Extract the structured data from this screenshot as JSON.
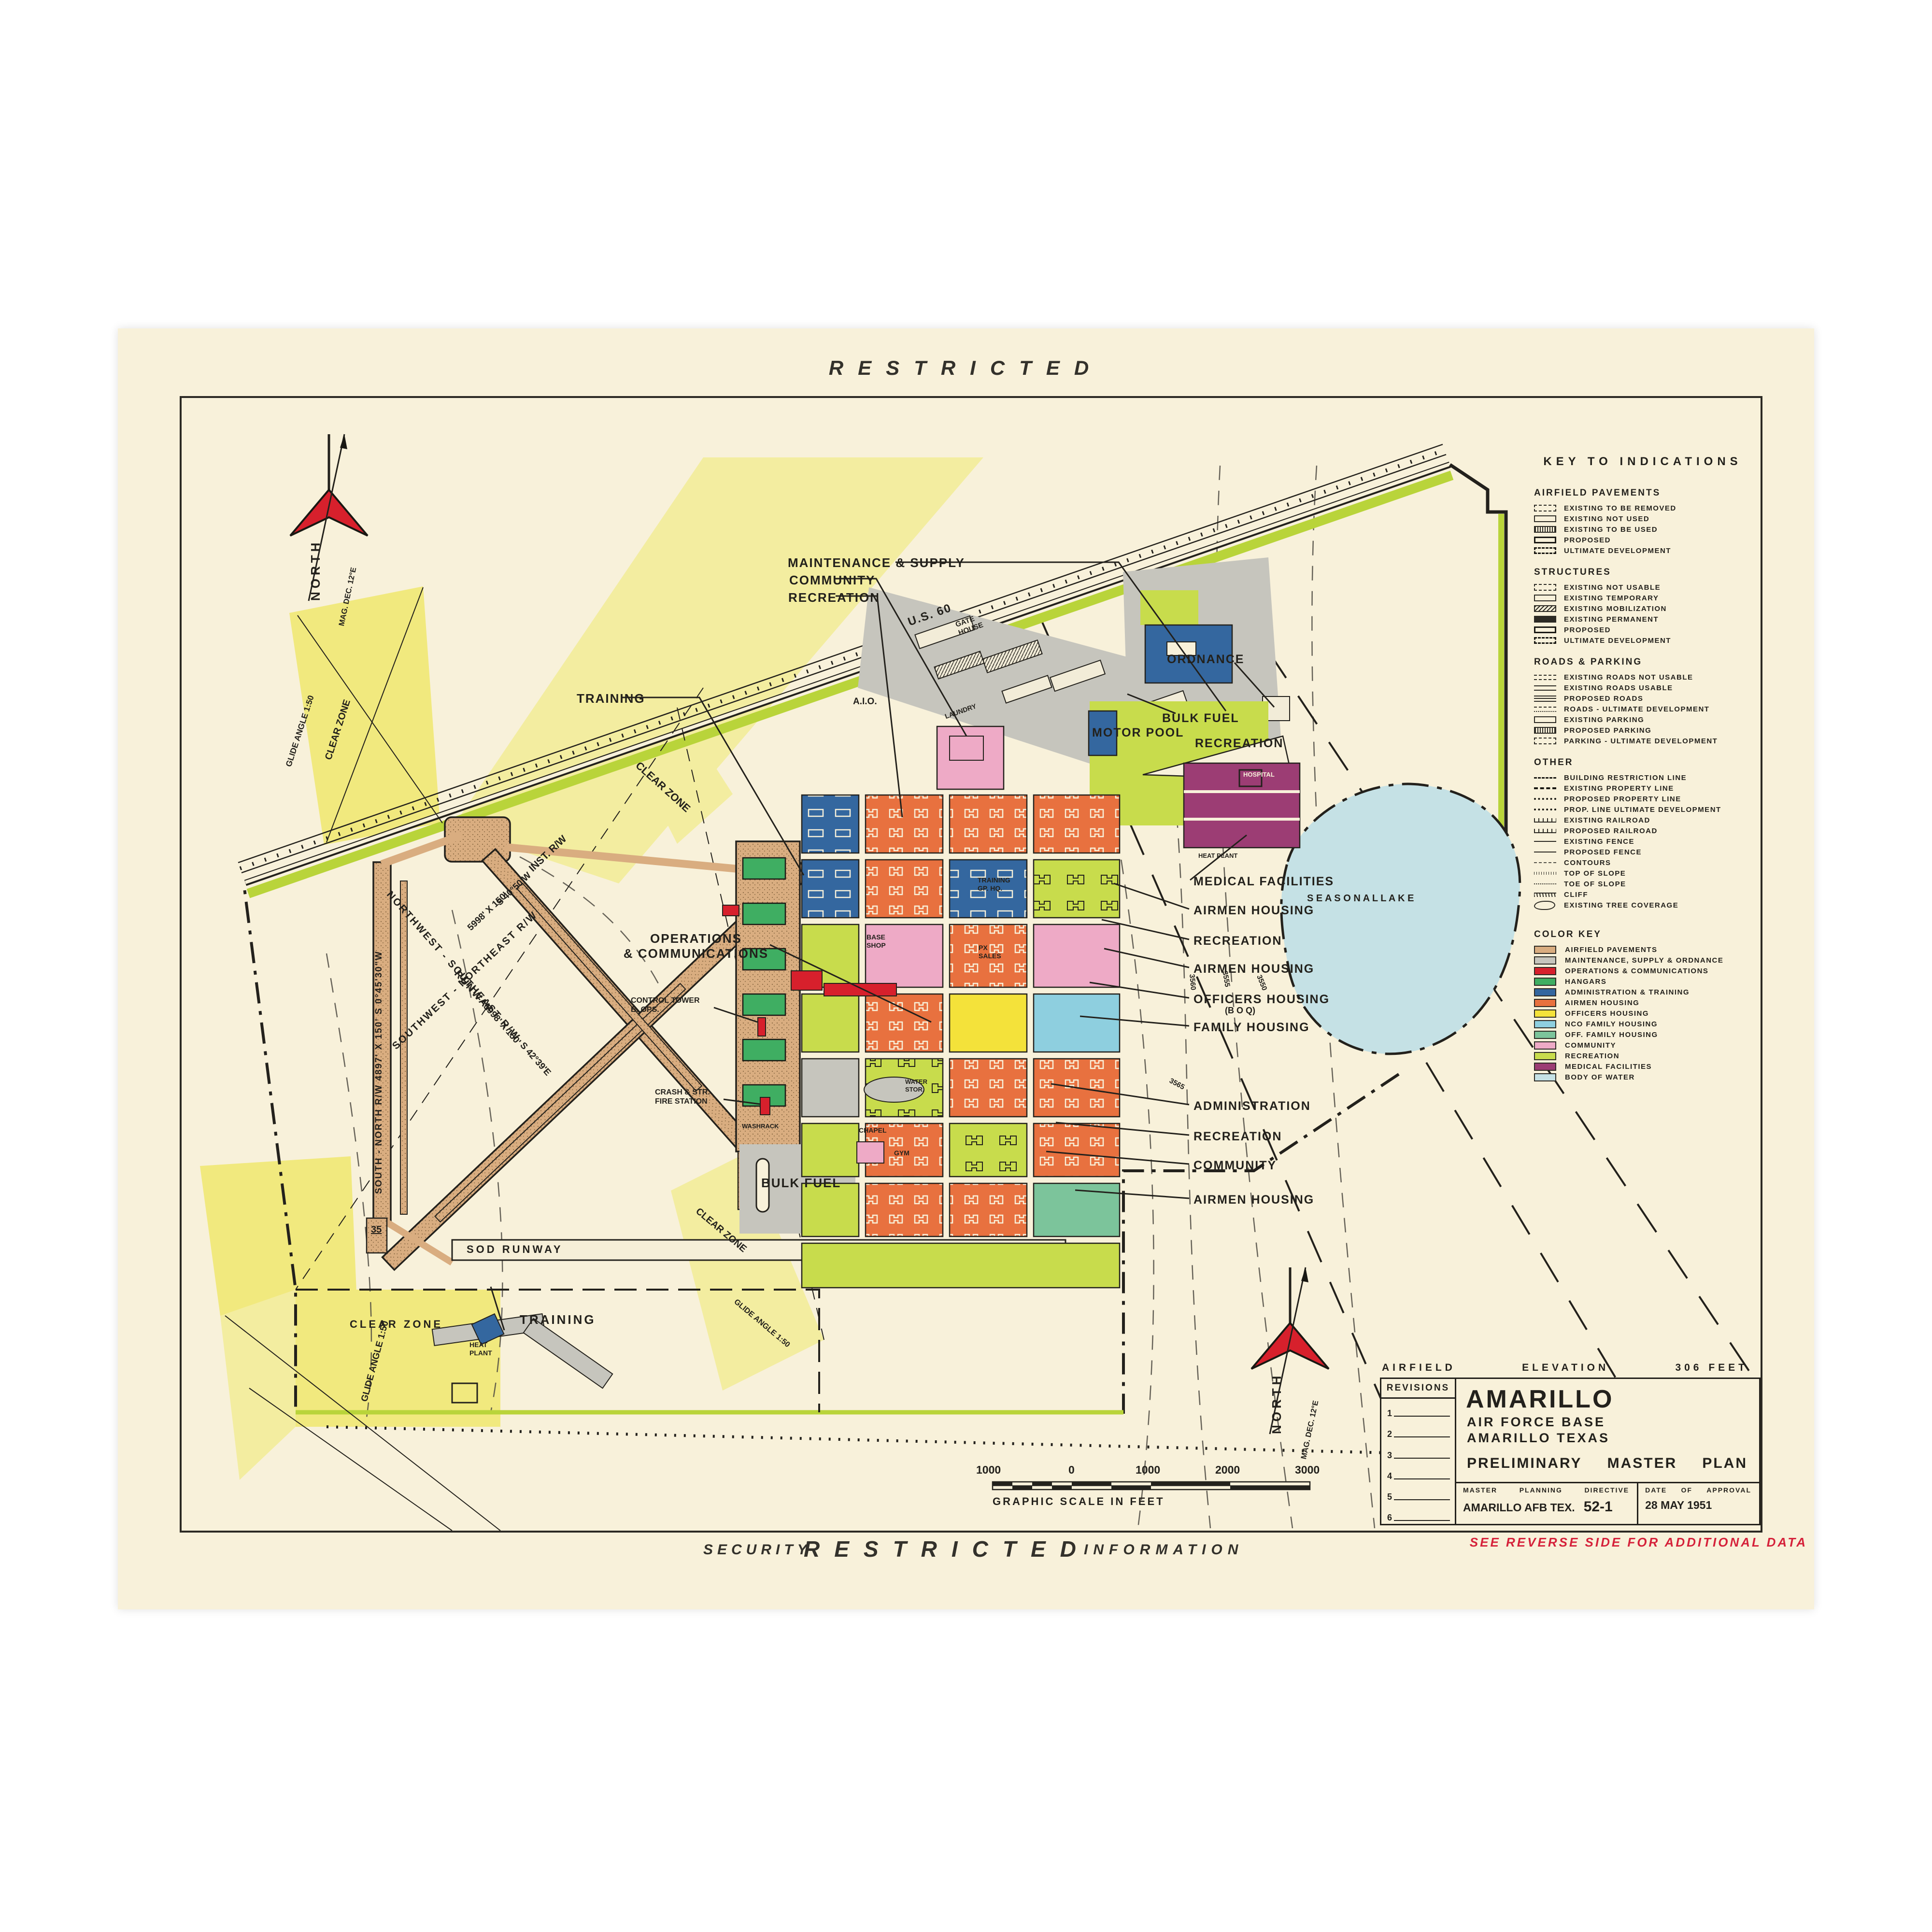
{
  "page": {
    "top_banner": "RESTRICTED",
    "security_word": "SECURITY",
    "restricted_word": "RESTRICTED",
    "information_word": "INFORMATION",
    "see_reverse": "SEE   REVERSE   SIDE   FOR   ADDITIONAL   DATA"
  },
  "colors": {
    "paper": "#f8f1da",
    "airfield_pavements": "#d9ad80",
    "maintenance_supply_ordnance": "#c6c5bd",
    "operations_communications": "#d7202c",
    "hangars": "#3fae62",
    "administration_training": "#34679f",
    "airmen_housing": "#e8713f",
    "officers_housing": "#f4e23a",
    "nco_family_housing": "#8ecfdf",
    "off_family_housing": "#7cc49b",
    "community": "#eeaac6",
    "recreation": "#c8dc4c",
    "medical_facilities": "#9c3d74",
    "body_of_water": "#c5e1e5",
    "clear_zone_yellow": "#f3eda0",
    "boundary_green": "#b9d43a",
    "north_arrow_red": "#d7202c",
    "security_red": "#d5213a"
  },
  "legend": {
    "title": "KEY  TO  INDICATIONS",
    "airfield_pavements": {
      "title": "AIRFIELD  PAVEMENTS",
      "items": [
        "EXISTING  TO  BE  REMOVED",
        "EXISTING  NOT  USED",
        "EXISTING  TO  BE  USED",
        "PROPOSED",
        "ULTIMATE  DEVELOPMENT"
      ]
    },
    "structures": {
      "title": "STRUCTURES",
      "items": [
        "EXISTING  NOT  USABLE",
        "EXISTING  TEMPORARY",
        "EXISTING  MOBILIZATION",
        "EXISTING  PERMANENT",
        "PROPOSED",
        "ULTIMATE  DEVELOPMENT"
      ]
    },
    "roads_parking": {
      "title": "ROADS  &  PARKING",
      "items": [
        "EXISTING  ROADS  NOT  USABLE",
        "EXISTING  ROADS  USABLE",
        "PROPOSED  ROADS",
        "ROADS - ULTIMATE  DEVELOPMENT",
        "EXISTING  PARKING",
        "PROPOSED  PARKING",
        "PARKING - ULTIMATE  DEVELOPMENT"
      ]
    },
    "other": {
      "title": "OTHER",
      "items": [
        "BUILDING  RESTRICTION  LINE",
        "EXISTING  PROPERTY  LINE",
        "PROPOSED  PROPERTY  LINE",
        "PROP. LINE  ULTIMATE  DEVELOPMENT",
        "EXISTING  RAILROAD",
        "PROPOSED  RAILROAD",
        "EXISTING  FENCE",
        "PROPOSED  FENCE",
        "CONTOURS",
        "TOP  OF  SLOPE",
        "TOE  OF  SLOPE",
        "CLIFF",
        "EXISTING  TREE  COVERAGE"
      ]
    },
    "color_key": {
      "title": "COLOR  KEY",
      "items": [
        {
          "label": "AIRFIELD  PAVEMENTS",
          "color": "#d9ad80"
        },
        {
          "label": "MAINTENANCE,  SUPPLY  &  ORDNANCE",
          "color": "#c6c5bd"
        },
        {
          "label": "OPERATIONS  &  COMMUNICATIONS",
          "color": "#d7202c"
        },
        {
          "label": "HANGARS",
          "color": "#3fae62"
        },
        {
          "label": "ADMINISTRATION  &  TRAINING",
          "color": "#34679f"
        },
        {
          "label": "AIRMEN  HOUSING",
          "color": "#e8713f"
        },
        {
          "label": "OFFICERS  HOUSING",
          "color": "#f4e23a"
        },
        {
          "label": "NCO  FAMILY  HOUSING",
          "color": "#8ecfdf"
        },
        {
          "label": "OFF.  FAMILY  HOUSING",
          "color": "#7cc49b"
        },
        {
          "label": "COMMUNITY",
          "color": "#eeaac6"
        },
        {
          "label": "RECREATION",
          "color": "#c8dc4c"
        },
        {
          "label": "MEDICAL  FACILITIES",
          "color": "#9c3d74"
        },
        {
          "label": "BODY  OF  WATER",
          "color": "#c5e1e5"
        }
      ]
    }
  },
  "scale_bar": {
    "labels": [
      "1000",
      "0",
      "1000",
      "2000",
      "3000"
    ],
    "caption": "GRAPHIC   SCALE   IN   FEET"
  },
  "title_block": {
    "elevation_left": "AIRFIELD",
    "elevation_mid": "ELEVATION",
    "elevation_right": "306  FEET",
    "revisions_title": "REVISIONS",
    "revisions": [
      "1",
      "2",
      "3",
      "4",
      "5",
      "6"
    ],
    "base_name": "AMARILLO",
    "base_line2": "AIR  FORCE  BASE",
    "base_line3": "AMARILLO TEXAS",
    "plan_word1": "PRELIMINARY",
    "plan_word2": "MASTER",
    "plan_word3": "PLAN",
    "mpd_label_1": "MASTER",
    "mpd_label_2": "PLANNING",
    "mpd_label_3": "DIRECTIVE",
    "mpd_value": "AMARILLO  AFB  TEX.",
    "mpd_number": "52-1",
    "approval_label_1": "DATE",
    "approval_label_2": "OF",
    "approval_label_3": "APPROVAL",
    "approval_date": "28  MAY  1951"
  },
  "map_labels": {
    "maintenance_supply": "MAINTENANCE  &  SUPPLY",
    "community_top": "COMMUNITY",
    "recreation_top": "RECREATION",
    "training_left": "TRAINING",
    "operations": "OPERATIONS\n& COMMUNICATIONS",
    "medical_facilities": "MEDICAL  FACILITIES",
    "airmen_housing_1": "AIRMEN  HOUSING",
    "recreation_1": "RECREATION",
    "airmen_housing_2": "AIRMEN  HOUSING",
    "officers_housing": "OFFICERS HOUSING",
    "officers_housing_sub": "(B O Q)",
    "family_housing": "FAMILY  HOUSING",
    "administration": "ADMINISTRATION",
    "recreation_2": "RECREATION",
    "community_mid": "COMMUNITY",
    "airmen_housing_3": "AIRMEN  HOUSING",
    "ordnance": "ORDNANCE",
    "bulk_fuel_upper": "BULK  FUEL",
    "motor_pool": "MOTOR  POOL",
    "recreation_lake": "RECREATION",
    "seasonal_lake": "S E A S O N A L      L A K E",
    "bulk_fuel_lower": "BULK  FUEL",
    "sod_runway": "SOD    RUNWAY",
    "training_annex": "TRAINING",
    "clear_zone_sw": "CLEAR    ZONE",
    "glide_angle_sw": "GLIDE  ANGLE   1:50",
    "clear_zone_nw": "CLEAR  ZONE",
    "glide_angle_nw": "GLIDE ANGLE  1:50",
    "clear_zone_mid": "CLEAR   ZONE",
    "clear_zone_se": "CLEAR  ZONE",
    "glide_angle_se": "GLIDE ANGLE  1:50",
    "us60": "U.S. 60",
    "gate_house": "GATE\nHOUSE",
    "aio": "A.I.O.",
    "laundry": "LAUNDRY",
    "north": "NORTH",
    "mag_dec": "MAG. DEC.  12°E",
    "rw_nw_se": "NORTHWEST - SOUTHEAST  R/W",
    "rw_sw_ne": "SOUTHWEST - NORTHEAST  R/W",
    "rw_runway": "RUNWAY",
    "rw_south_north": "SOUTH - NORTH  R/W    4897' X 150'    S 0°45'30\"W",
    "rw_inst": "INST.  R/W",
    "rw_s4050": "S 40°50'W",
    "rw_5998_a": "5998'  X  150'",
    "rw_5998_b": "5998'  X  150'",
    "rw_s4239": "S 42°39'E",
    "runway_35": "35",
    "control_tower": "CONTROL  TOWER\nB. OPS.",
    "crash_fire": "CRASH & STR.\nFIRE STATION",
    "training_gp_hq": "TRAINING\nGP. HQ.",
    "base_shop": "BASE\nSHOP",
    "px_sales": "PX\nSALES",
    "gym": "GYM",
    "chapel": "CHAPEL",
    "water_stor": "WATER\nSTOR.",
    "washrack": "WASHRACK",
    "hospital": "HOSPITAL",
    "heat_plant_hosp": "HEAT  PLANT",
    "heat_plant_annex": "HEAT\nPLANT",
    "contour_3550": "3550",
    "contour_3555": "3555",
    "contour_3560": "3560",
    "contour_3565": "3565"
  }
}
